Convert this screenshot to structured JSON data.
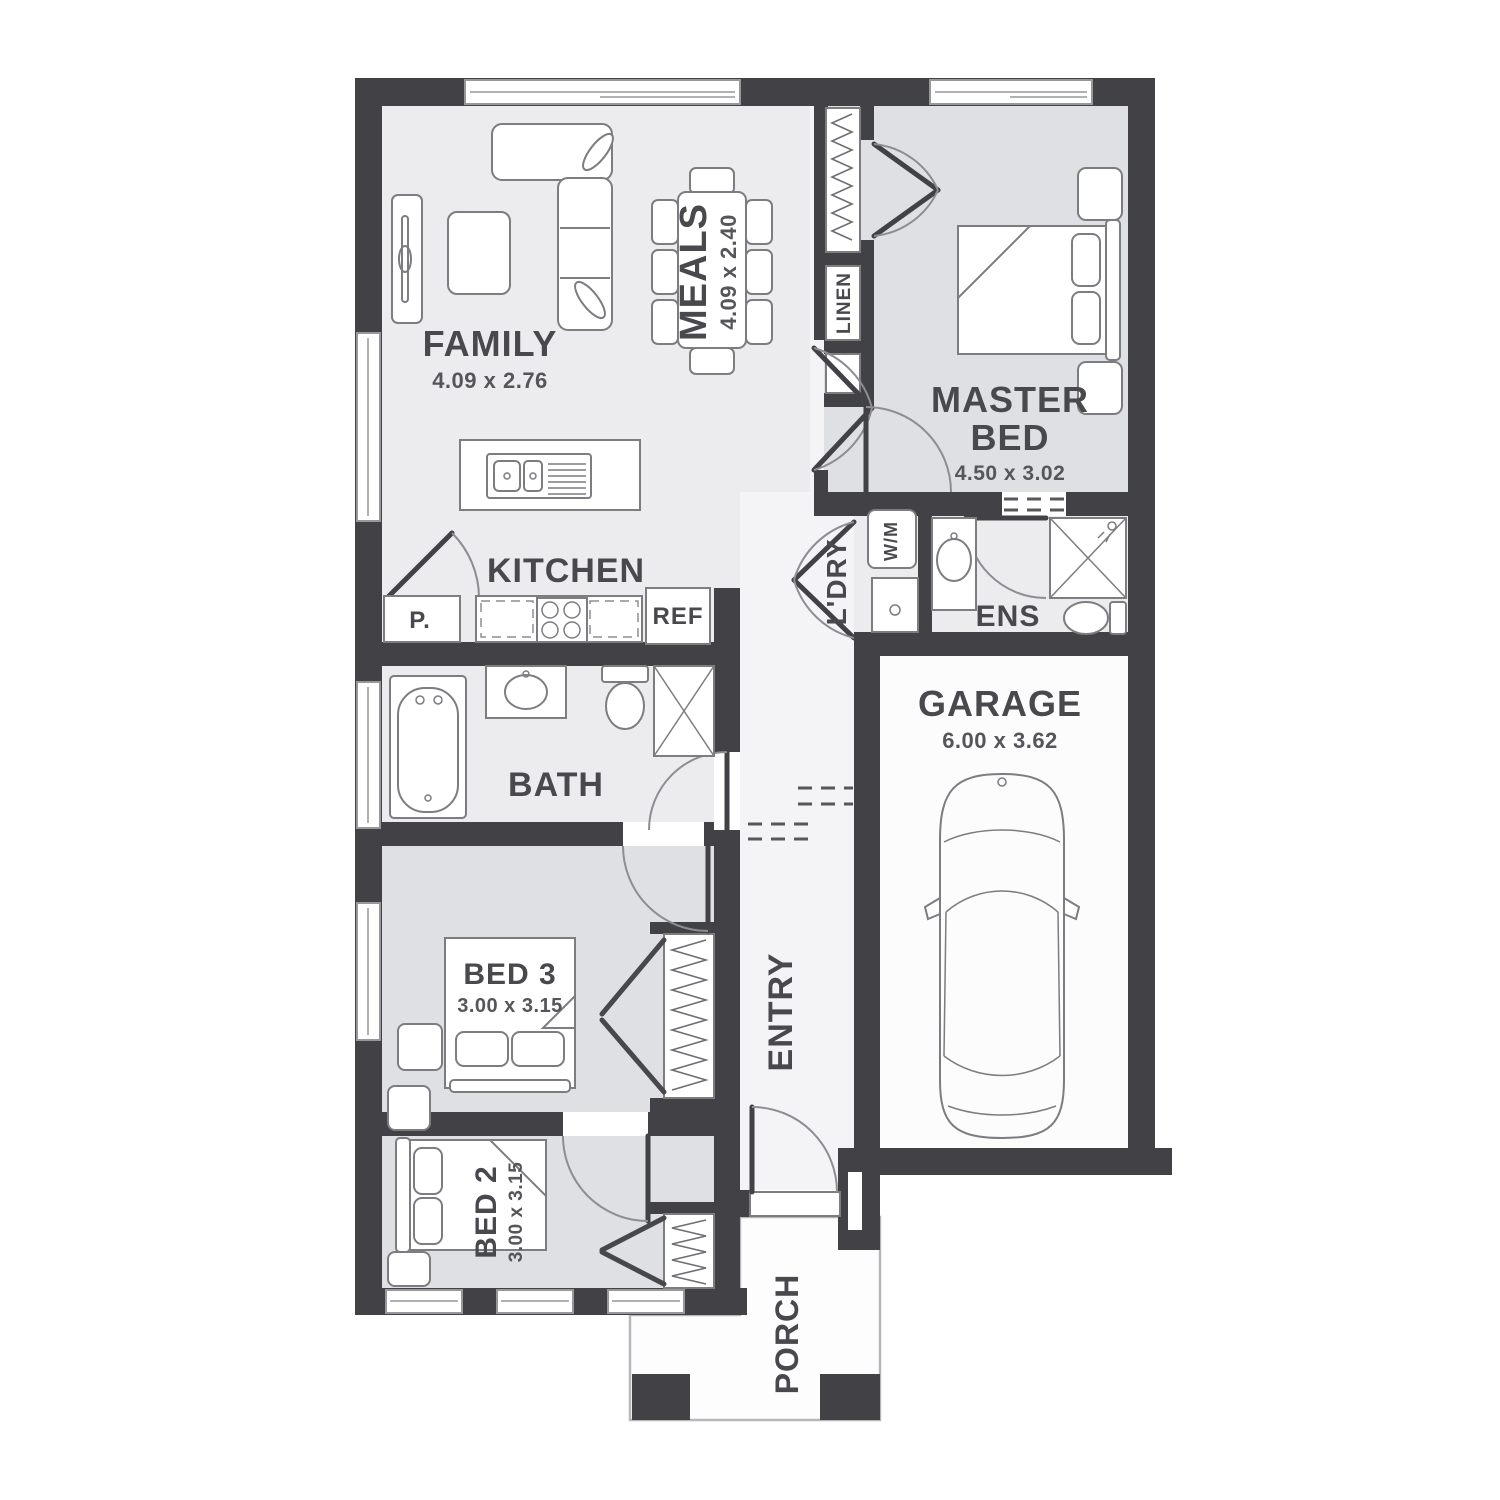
{
  "plan": {
    "type": "residential-floor-plan",
    "colors": {
      "wall": "#414146",
      "light": "#ececee",
      "bedroom": "#dfe0e3",
      "hall": "#f4f4f6",
      "garage": "#fcfcfd",
      "line": "#7c7c81",
      "label": "#48484d"
    }
  },
  "rooms": {
    "family": {
      "label": "FAMILY",
      "dims": "4.09 x 2.76"
    },
    "meals": {
      "label": "MEALS",
      "dims": "4.09 x 2.40"
    },
    "master": {
      "label1": "MASTER",
      "label2": "BED",
      "dims": "4.50 x 3.02"
    },
    "linen": {
      "label": "LINEN"
    },
    "kitchen": {
      "label": "KITCHEN"
    },
    "pantry": {
      "label": "P."
    },
    "fridge": {
      "label": "REF"
    },
    "laundry": {
      "label": "L'DRY"
    },
    "washer": {
      "label": "W/M"
    },
    "ensuite": {
      "label": "ENS"
    },
    "bath": {
      "label": "BATH"
    },
    "garage": {
      "label": "GARAGE",
      "dims": "6.00 x 3.62"
    },
    "bed3": {
      "label": "BED 3",
      "dims": "3.00 x 3.15"
    },
    "bed2": {
      "label": "BED 2",
      "dims": "3.00 x 3.15"
    },
    "entry": {
      "label": "ENTRY"
    },
    "porch": {
      "label": "PORCH"
    }
  }
}
